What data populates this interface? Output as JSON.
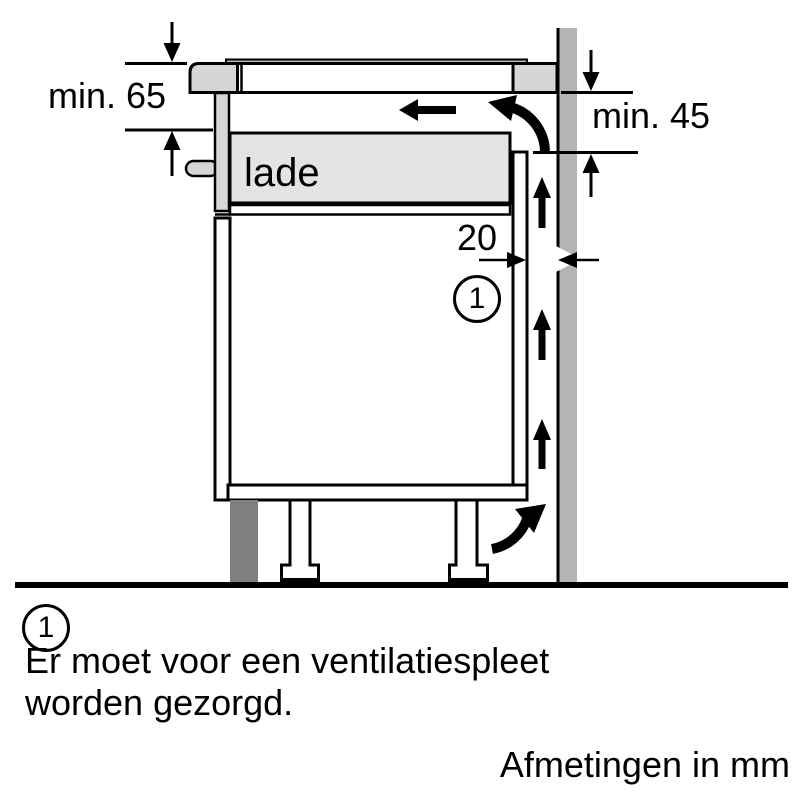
{
  "diagram": {
    "dim_left_label": "min. 65",
    "dim_right_label": "min. 45",
    "gap_dim_label": "20",
    "drawer_label": "lade",
    "callout_number": "1"
  },
  "footnote": {
    "marker_number": "1",
    "text_line1": "Er moet voor een ventilatiespleet",
    "text_line2": "worden gezorgd."
  },
  "units_caption": "Afmetingen in mm",
  "colors": {
    "background": "#ffffff",
    "outline": "#000000",
    "hob_gray": "#d6d6d6",
    "glass_gray": "#b8b8b8",
    "drawer_gray": "#e3e3e3",
    "wall_gray": "#b4b4b4",
    "plinth_gray": "#7f7f7f"
  }
}
